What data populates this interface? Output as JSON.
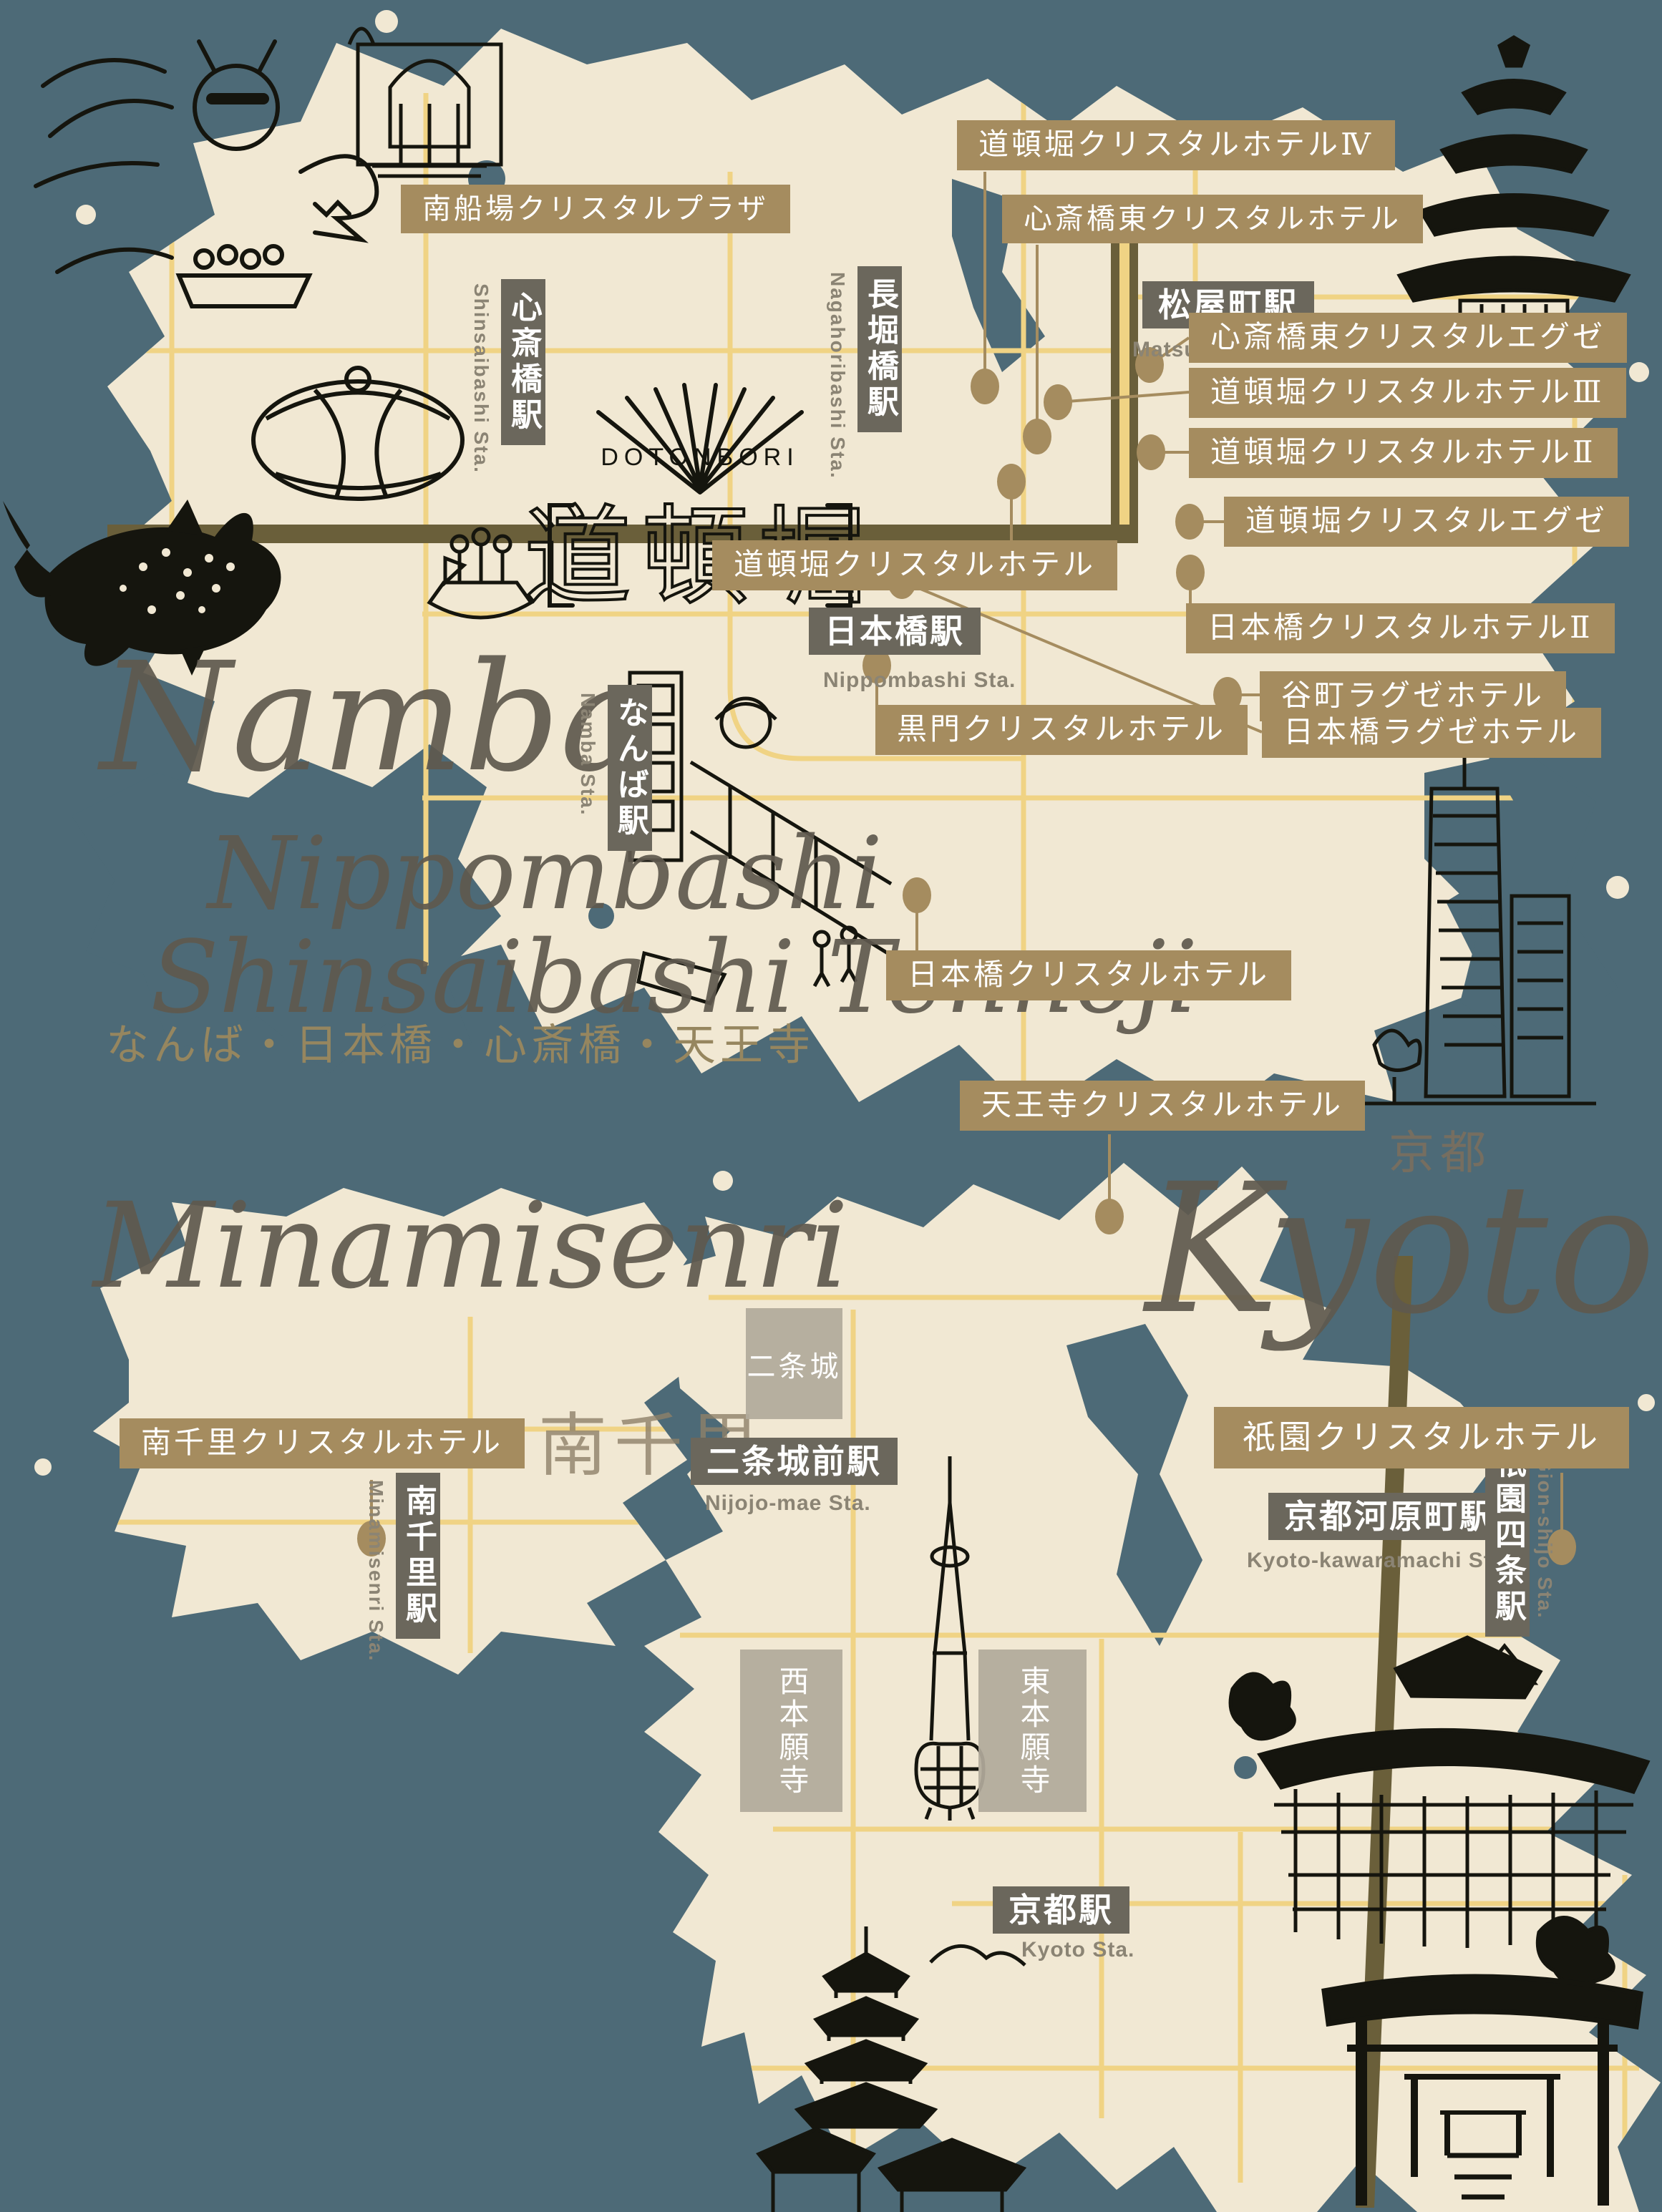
{
  "colors": {
    "background": "#4d6a77",
    "land": "#f1e8d3",
    "road": "#f0d384",
    "railway": "#6a5f3a",
    "hotel_label_bg": "#a58c5f",
    "station_label_bg": "#6b675c",
    "romaji_text": "#8b8474",
    "script_text": "#5f594e",
    "landmark_box_bg": "#b3ab9b"
  },
  "osaka": {
    "script_title_lines": [
      "Namba",
      "Nippombashi",
      "Shinsaibashi Tennoji"
    ],
    "subtitle_jp": "なんば・日本橋・心斎橋・天王寺",
    "dotonbori_sign": {
      "en": "DOTONBORI",
      "jp": "道頓堀"
    },
    "hotels": [
      {
        "label": "南船場クリスタルプラザ"
      },
      {
        "label": "道頓堀クリスタルホテルⅣ"
      },
      {
        "label": "心斎橋東クリスタルホテル"
      },
      {
        "label": "心斎橋東クリスタルエグゼ"
      },
      {
        "label": "道頓堀クリスタルホテルⅢ"
      },
      {
        "label": "道頓堀クリスタルホテルⅡ"
      },
      {
        "label": "道頓堀クリスタルエグゼ"
      },
      {
        "label": "道頓堀クリスタルホテル"
      },
      {
        "label": "日本橋クリスタルホテルⅡ"
      },
      {
        "label": "谷町ラグゼホテル"
      },
      {
        "label": "黒門クリスタルホテル"
      },
      {
        "label": "日本橋ラグゼホテル"
      },
      {
        "label": "日本橋クリスタルホテル"
      },
      {
        "label": "天王寺クリスタルホテル"
      }
    ],
    "stations": [
      {
        "name": "心斎橋駅",
        "romaji": "Shinsaibashi Sta."
      },
      {
        "name": "長堀橋駅",
        "romaji": "Nagahoribashi Sta."
      },
      {
        "name": "松屋町駅",
        "romaji": "Matsuyamachi Sta."
      },
      {
        "name": "日本橋駅",
        "romaji": "Nippombashi Sta."
      },
      {
        "name": "なんば駅",
        "romaji": "Namba Sta."
      }
    ]
  },
  "minamisenri": {
    "script_title": "Minamisenri",
    "kanji_title": "南千里",
    "hotels": [
      {
        "label": "南千里クリスタルホテル"
      }
    ],
    "stations": [
      {
        "name": "南千里駅",
        "romaji": "Minamisenri Sta."
      }
    ]
  },
  "kyoto": {
    "script_title": "Kyoto",
    "kanji_title": "京都",
    "hotels": [
      {
        "label": "祇園クリスタルホテル"
      }
    ],
    "stations": [
      {
        "name": "二条城前駅",
        "romaji": "Nijojo-mae Sta."
      },
      {
        "name": "京都河原町駅",
        "romaji": "Kyoto-kawaramachi Sta."
      },
      {
        "name": "祇園四条駅",
        "romaji": "Gion-shijo Sta."
      },
      {
        "name": "京都駅",
        "romaji": "Kyoto Sta."
      }
    ],
    "landmarks": [
      {
        "name": "二条城"
      },
      {
        "name": "西本願寺"
      },
      {
        "name": "東本願寺"
      }
    ]
  },
  "illustrations": [
    "dinosaur-park-illustration",
    "theater-building-illustration",
    "osaka-castle-illustration",
    "osaka-dome-illustration",
    "whale-shark-illustration",
    "takoyaki-boat-illustration",
    "namba-street-illustration",
    "abeno-harukas-illustration",
    "kyoto-tower-illustration",
    "kiyomizu-dera-illustration",
    "toji-pagoda-illustration",
    "fushimi-inari-torii-illustration"
  ]
}
